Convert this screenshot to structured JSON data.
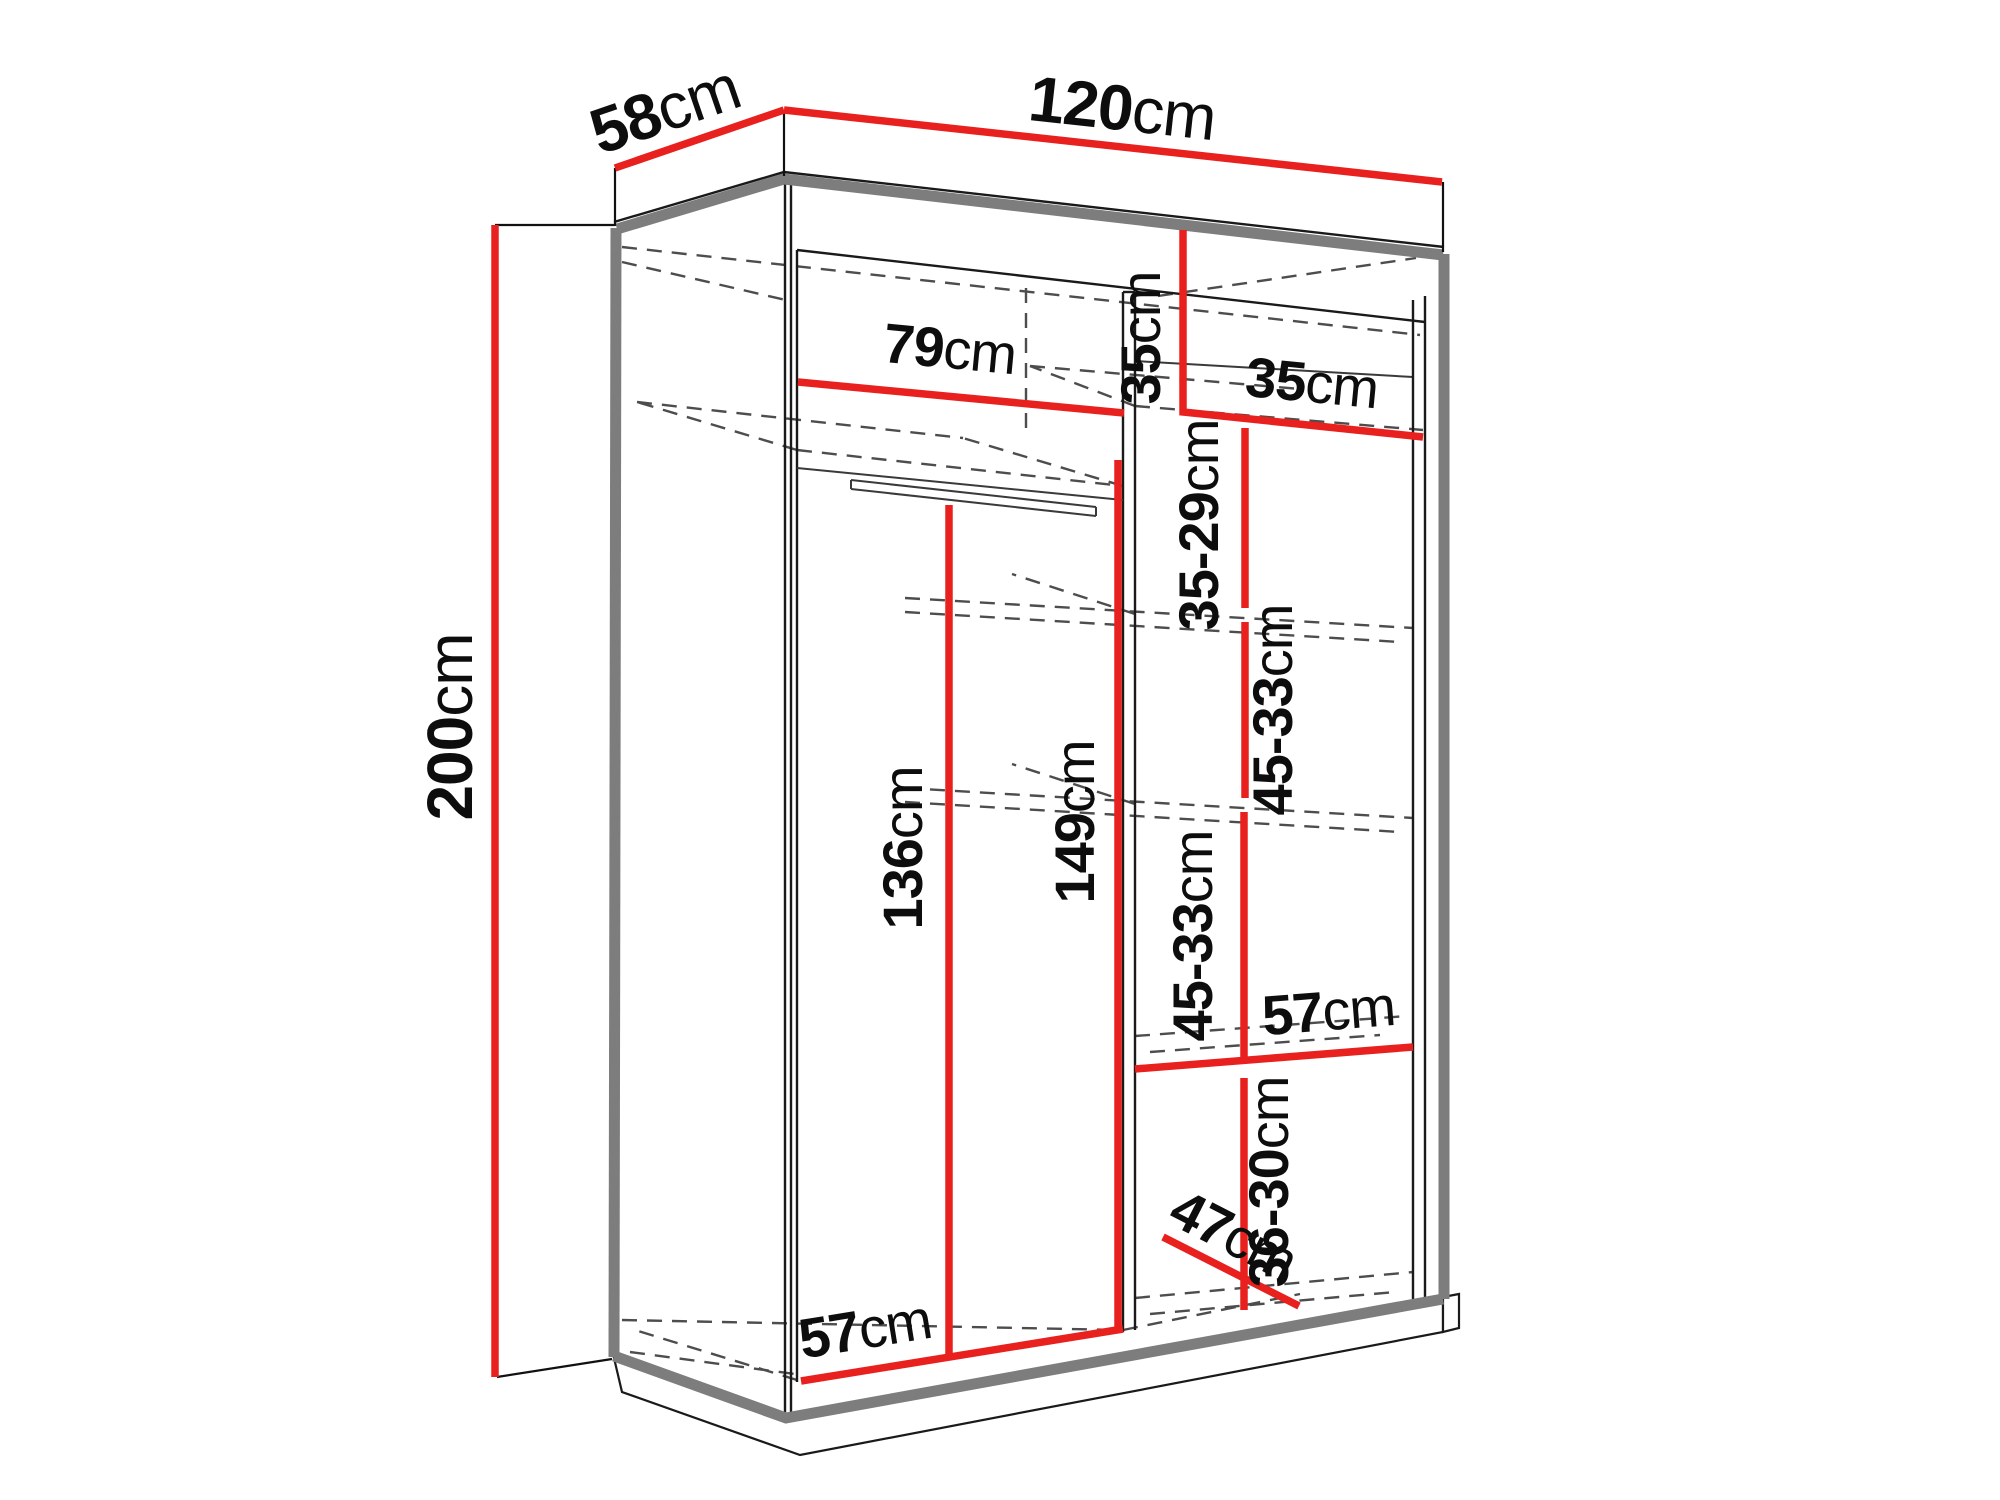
{
  "diagram": {
    "type": "wardrobe-dimension-diagram",
    "subject": "sliding-door wardrobe interior dimensions",
    "canvas": {
      "width": 2000,
      "height": 1500,
      "background": "#ffffff"
    },
    "colors": {
      "dimension_line": "#e8201e",
      "outline": "#1a1a1a",
      "shadow_edge": "#7d7d7d",
      "hidden_line": "#4d4d4d",
      "label_text": "#0d0d0d"
    },
    "labels": {
      "depth": "58cm",
      "width": "120cm",
      "height": "200cm",
      "top_inner_width": "79cm",
      "cubby_height": "35cm",
      "cubby_width": "35cm",
      "shelf_gap_top": "35-29cm",
      "shelf_gap_upper": "45-33cm",
      "shelf_gap_lower": "45-33cm",
      "right_shelf_width": "57cm",
      "shelf_gap_bottom": "36-30cm",
      "hanging_height": "136cm",
      "right_section_height": "149cm",
      "bottom_inner_width": "57cm",
      "bottom_depth": "47cm"
    }
  }
}
